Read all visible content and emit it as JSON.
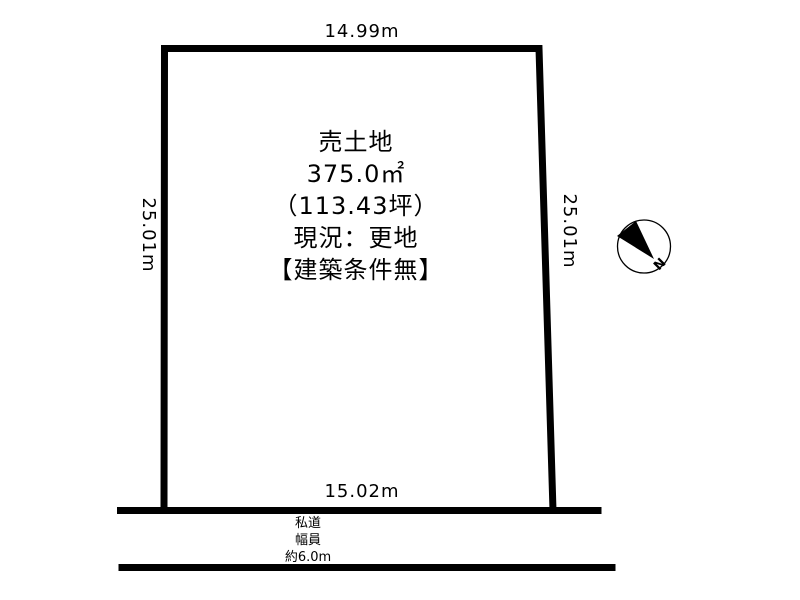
{
  "diagram": {
    "parcel": {
      "label_lines": {
        "0": "売土地",
        "1": "375.0㎡",
        "2": "（113.43坪）",
        "3": "現況：更地",
        "4": "【建築条件無】"
      },
      "dimensions": {
        "top": "14.99m",
        "left": "25.01m",
        "right": "25.01m",
        "bottom": "15.02m"
      }
    },
    "road": {
      "lines": {
        "0": "私道",
        "1": "幅員",
        "2": "約6.0m"
      }
    },
    "compass": {
      "north_label": "N"
    },
    "colors": {
      "line": "#000000",
      "background": "#ffffff"
    }
  }
}
